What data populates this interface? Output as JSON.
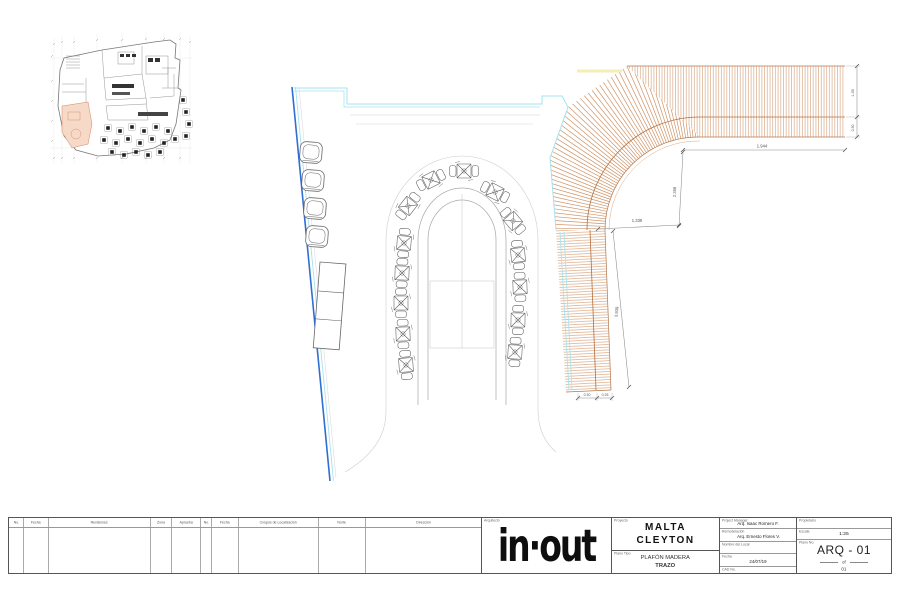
{
  "title_block": {
    "revision_table": {
      "columns": [
        {
          "label": "No.",
          "w": 15
        },
        {
          "label": "Fecha",
          "w": 25
        },
        {
          "label": "Revisiones",
          "w": 102
        },
        {
          "label": "Zona",
          "w": 21
        },
        {
          "label": "Aprueba",
          "w": 29
        },
        {
          "label": "No.",
          "w": 11
        },
        {
          "label": "Fecha",
          "w": 27
        },
        {
          "label": "Croquis de Localización",
          "w": 80
        },
        {
          "label": "Norte",
          "w": 47
        },
        {
          "label": "Dirección",
          "w": 115
        }
      ]
    },
    "architect_label": "Arquitecto",
    "logo_text": "in·out",
    "project": {
      "label": "Proyecto",
      "line1": "MALTA",
      "line2": "CLEYTON"
    },
    "plan_type": {
      "label": "Plano Tipo",
      "line1": "PLAFÓN MADERA",
      "line2": "TRAZO"
    },
    "credits": [
      {
        "label": "Project Manager",
        "value": "Arq. Isaac Romero F."
      },
      {
        "label": "Remodelación",
        "value": "Arq. Ernesto Flores V."
      },
      {
        "label": "Nombre del Local",
        "value": ""
      },
      {
        "label": "Fecha",
        "value": "24/07/19"
      },
      {
        "label": "CAD No.",
        "value": ""
      }
    ],
    "owner": {
      "label": "Propietario",
      "value": ""
    },
    "scale": {
      "label": "Escala",
      "value": "1:25"
    },
    "sheet_no": {
      "label": "Plano No.",
      "value": "ARQ - 01",
      "of": "of",
      "total": "01"
    }
  },
  "drawing": {
    "dimensions": {
      "top": "1.944",
      "drop": "2.358",
      "corner": "1.339",
      "band": "3.939",
      "edge_a": "1.35",
      "edge_b": "0.30",
      "foot_a": "0.30",
      "foot_b": "0.25"
    },
    "tables": [
      [
        408,
        206,
        -52
      ],
      [
        431,
        180,
        -27
      ],
      [
        464,
        171,
        0
      ],
      [
        495,
        192,
        27
      ],
      [
        513,
        221,
        50
      ],
      [
        404,
        243,
        -86
      ],
      [
        402,
        273,
        -88
      ],
      [
        401,
        303,
        -90
      ],
      [
        403,
        334,
        -92
      ],
      [
        406,
        365,
        -94
      ],
      [
        518,
        255,
        85
      ],
      [
        520,
        287,
        88
      ],
      [
        518,
        320,
        91
      ],
      [
        515,
        352,
        93
      ]
    ],
    "lounge_chairs": [
      [
        311,
        152
      ],
      [
        313,
        180
      ],
      [
        315,
        208
      ],
      [
        317,
        236
      ]
    ],
    "colors": {
      "wall_blue": "#2f6fd1",
      "wall_cyan": "#a5e3ee",
      "wood": "#cf9468",
      "wood_dark": "#b3703f",
      "highlight_yellow": "#f3eeb4",
      "keyplan_highlight": "#f6d9c6"
    }
  }
}
